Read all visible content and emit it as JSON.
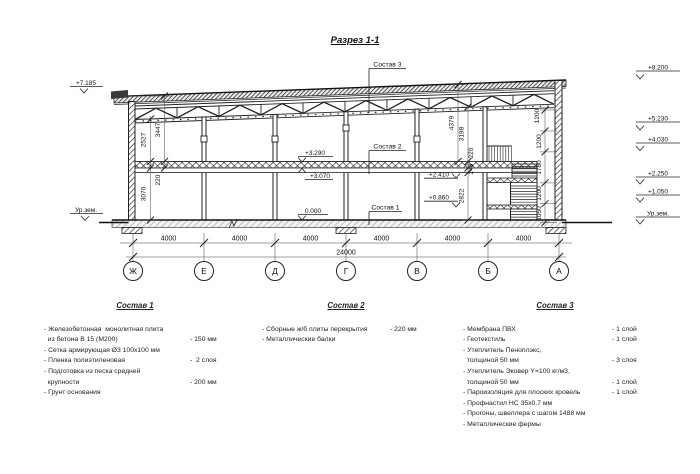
{
  "section": {
    "title": "Разрез 1-1",
    "axis_labels": [
      "Ж",
      "Е",
      "Д",
      "Г",
      "В",
      "Б",
      "А"
    ],
    "span_dims": [
      "4000",
      "4000",
      "4000",
      "4000",
      "4000",
      "4000"
    ],
    "total_dim": "24000",
    "marks": {
      "left_top": "+7.185",
      "left_ground": "Ур.зем.",
      "right": [
        "+8.200",
        "+5.230",
        "+4.030",
        "+2.250",
        "+1.050",
        "Ур.зем."
      ],
      "slab_top": "+3.290",
      "slab_bottom": "+3.070",
      "floor": "0.000",
      "landing_upper": "+2.410",
      "landing_lower": "+0.860"
    },
    "vdims": {
      "left": [
        "2527",
        "3447",
        "220",
        "3070"
      ],
      "mid": [
        "4379",
        "3198",
        "220",
        "248",
        "2822"
      ],
      "right": [
        "1200",
        "1200",
        "1780",
        "1200",
        "1050"
      ]
    },
    "callouts": [
      "Состав 3",
      "Состав 2",
      "Состав 1"
    ]
  },
  "colors": {
    "ink": "#1d1d1d",
    "background": "#ffffff"
  },
  "compositions": [
    {
      "title": "Состав 1",
      "items": [
        {
          "text": "- Железобетонная  монолитная плита",
          "value": ""
        },
        {
          "text": "  из бетона В 15 (М200)",
          "value": "- 150 мм"
        },
        {
          "text": "- Сетка армирующая Ø3 100х100 мм",
          "value": ""
        },
        {
          "text": "- Пленка полиэтиленовая",
          "value": "-  2 слоя"
        },
        {
          "text": "- Подготовка из песка средней",
          "value": ""
        },
        {
          "text": "  крупности",
          "value": "- 200 мм"
        },
        {
          "text": "- Грунт основания",
          "value": ""
        }
      ]
    },
    {
      "title": "Состав 2",
      "items": [
        {
          "text": "- Сборные ж/б плиты перекрытия",
          "value": "- 220 мм"
        },
        {
          "text": "- Металлические балки",
          "value": ""
        }
      ]
    },
    {
      "title": "Состав 3",
      "items": [
        {
          "text": "- Мембрана ПВХ",
          "value": "- 1 слой"
        },
        {
          "text": "- Геотекстиль",
          "value": "- 1 слой"
        },
        {
          "text": "- Утеплитель Пеноплэкс,",
          "value": ""
        },
        {
          "text": "  толщиной 50 мм",
          "value": "- 3 слоя"
        },
        {
          "text": "- Утеплитель Эковер Y=100 кг/м3,",
          "value": ""
        },
        {
          "text": "  толщиной 50 мм",
          "value": "- 1 слой"
        },
        {
          "text": "- Пароизоляция для плоских кровель",
          "value": "- 1 слой"
        },
        {
          "text": "- Профнастил НС 35х0.7 мм",
          "value": ""
        },
        {
          "text": "- Прогоны, швеллера с шагом 1488 мм",
          "value": ""
        },
        {
          "text": "- Металлические фермы",
          "value": ""
        }
      ]
    }
  ]
}
